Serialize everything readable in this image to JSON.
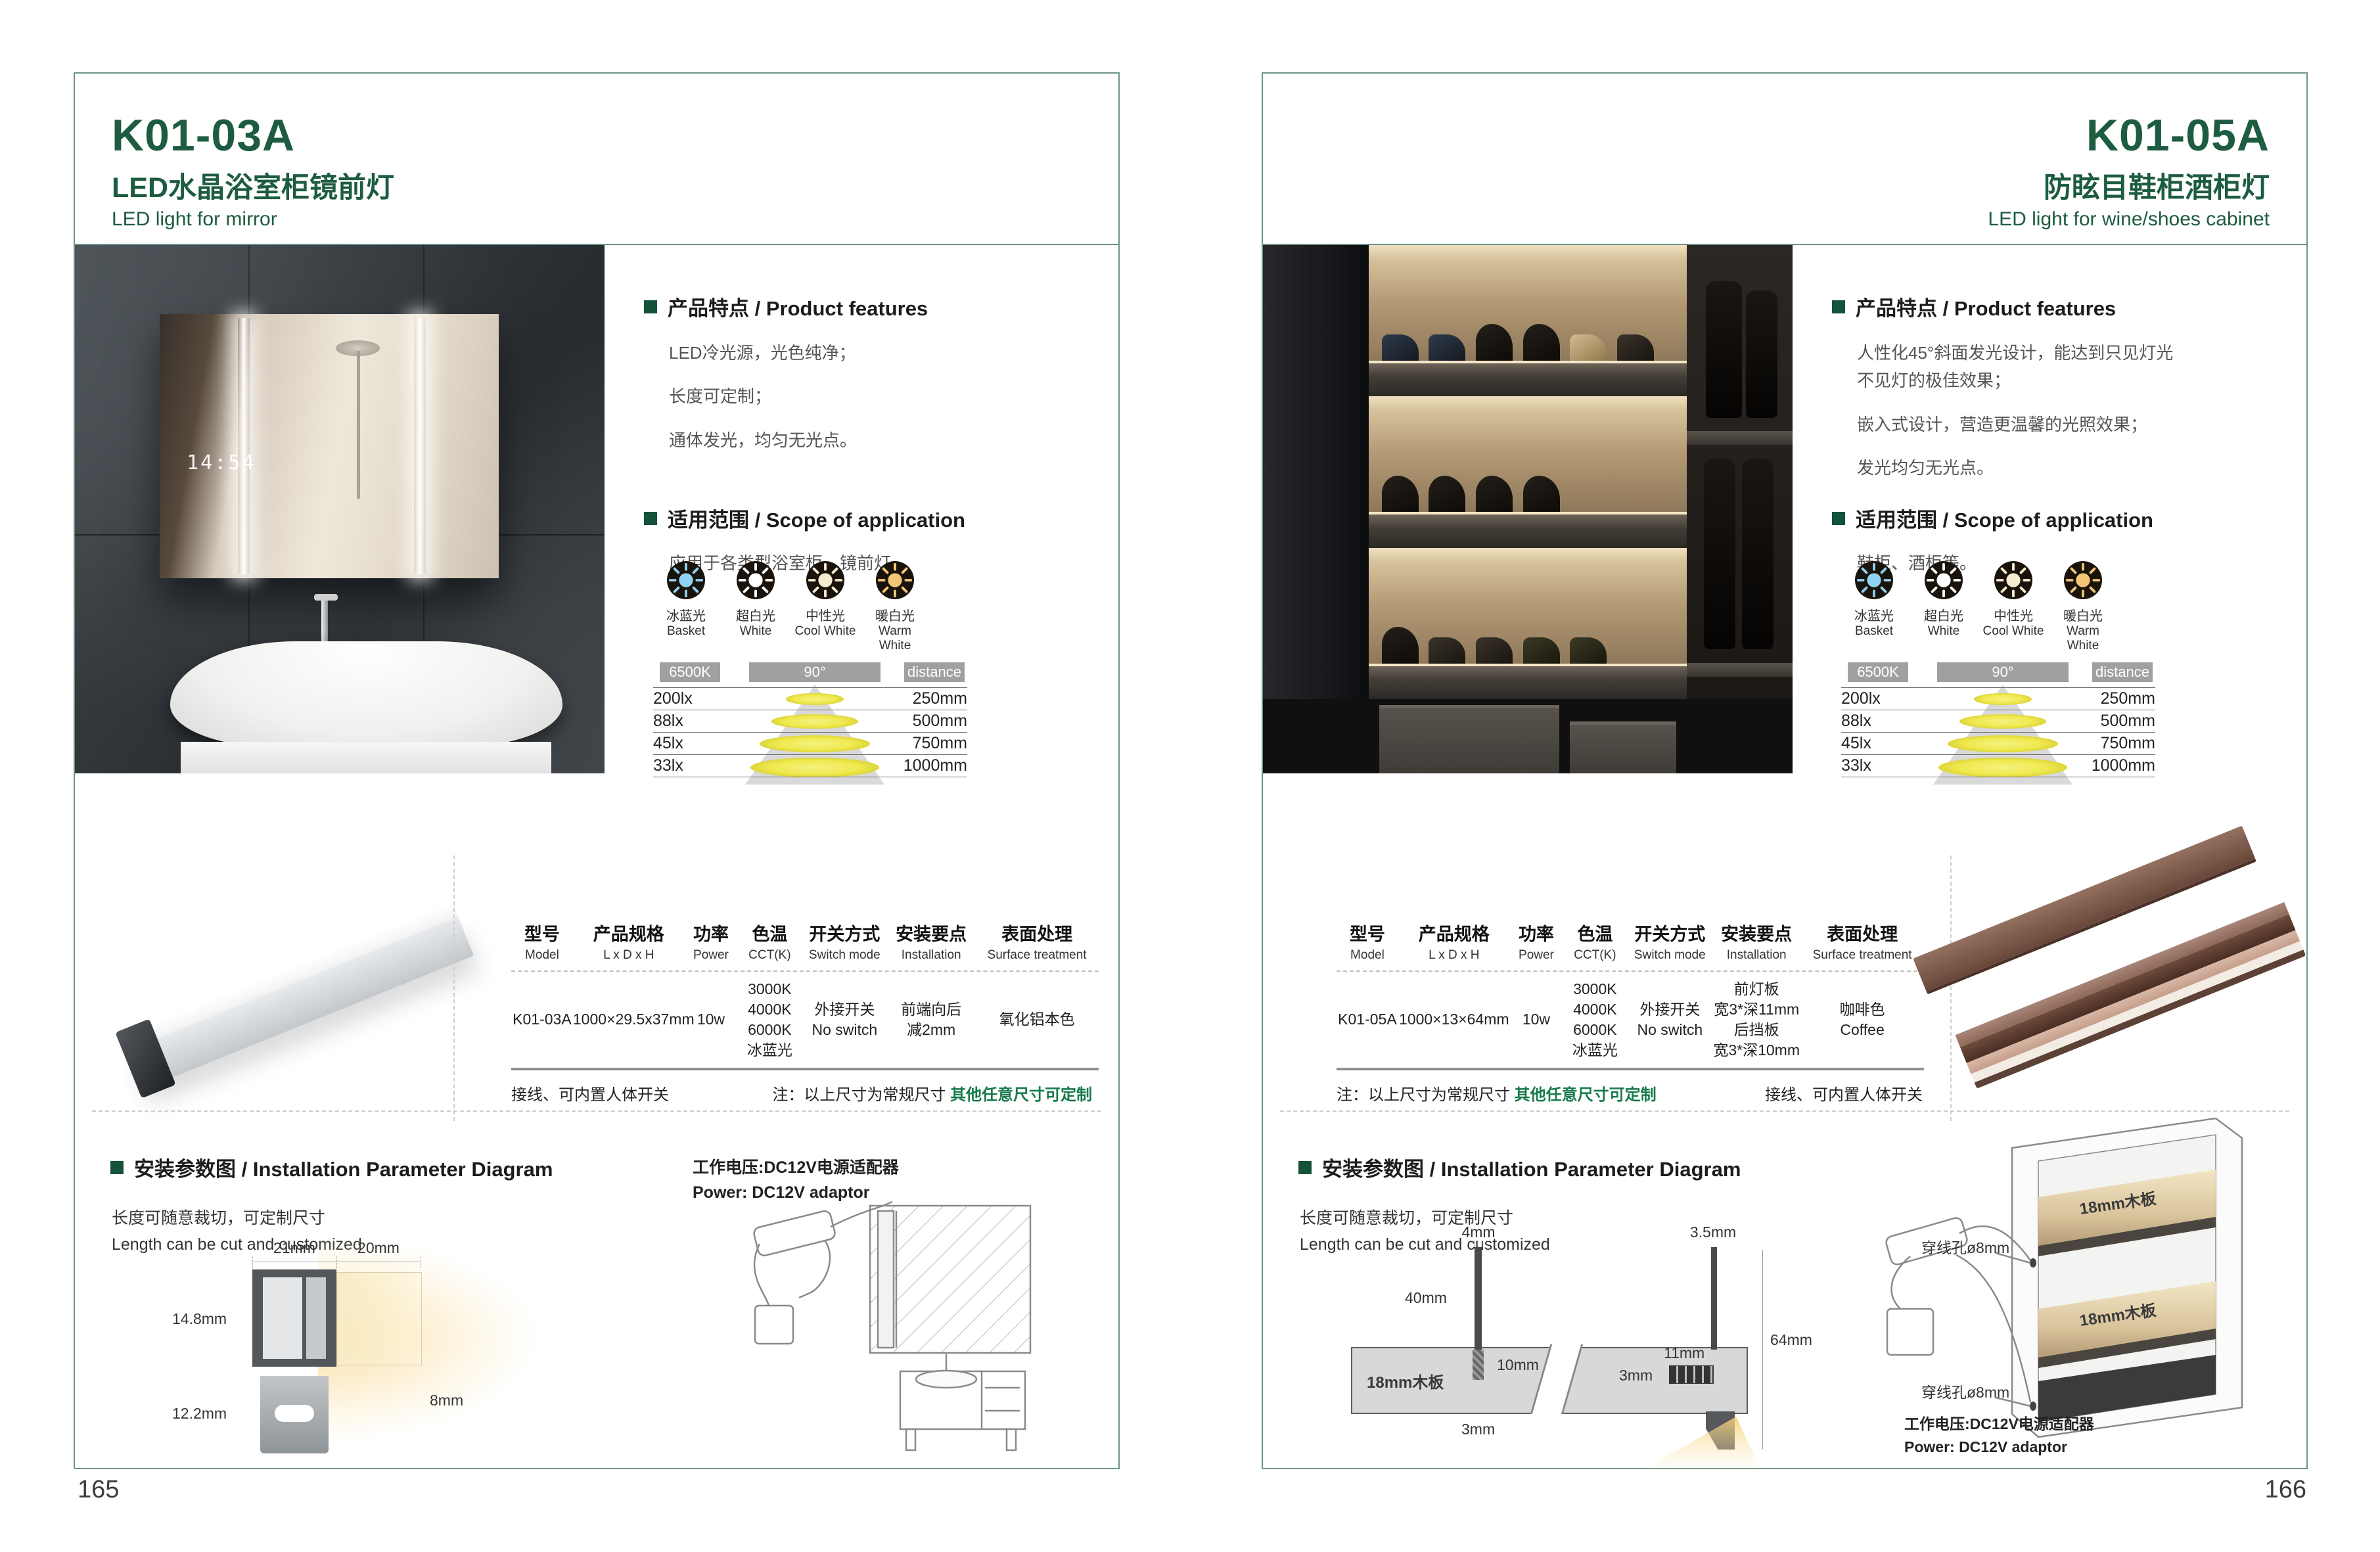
{
  "colors": {
    "brand_green": "#1d5c40",
    "frame_teal": "#6b958a",
    "note_green": "#167a4a",
    "bar_gray": "#a0a0a0"
  },
  "page_numbers": {
    "left": "165",
    "right": "166"
  },
  "shared": {
    "features_header": "产品特点 / Product features",
    "scope_header": "适用范围 / Scope of application",
    "install_header": "安装参数图 / Installation Parameter Diagram",
    "length_note_cn": "长度可随意裁切，可定制尺寸",
    "length_note_en": "Length can be cut and customized",
    "power_note_cn": "工作电压:DC12V电源适配器",
    "power_note_en": "Power: DC12V adaptor",
    "wiring_note": "接线、可内置人体开关",
    "size_note_black": "注：以上尺寸为常规尺寸",
    "size_note_green": "其他任意尺寸可定制",
    "light_options": [
      {
        "cn": "冰蓝光",
        "en": "Basket",
        "color": "#8fd2f2"
      },
      {
        "cn": "超白光",
        "en": "White",
        "color": "#ffffff"
      },
      {
        "cn": "中性光",
        "en": "Cool White",
        "color": "#f6ecd0"
      },
      {
        "cn": "暖白光",
        "en": "Warm White",
        "color": "#f2c674"
      }
    ],
    "beam": {
      "cct": "6500K",
      "angle": "90°",
      "distance": "distance",
      "rows": [
        {
          "lux": "200lx",
          "dist": "250mm"
        },
        {
          "lux": "88lx",
          "dist": "500mm"
        },
        {
          "lux": "45lx",
          "dist": "750mm"
        },
        {
          "lux": "33lx",
          "dist": "1000mm"
        }
      ]
    },
    "table_headers": [
      {
        "cn": "型号",
        "en": "Model"
      },
      {
        "cn": "产品规格",
        "en": "L x D x H"
      },
      {
        "cn": "功率",
        "en": "Power"
      },
      {
        "cn": "色温",
        "en": "CCT(K)"
      },
      {
        "cn": "开关方式",
        "en": "Switch mode"
      },
      {
        "cn": "安装要点",
        "en": "Installation"
      },
      {
        "cn": "表面处理",
        "en": "Surface treatment"
      }
    ]
  },
  "left": {
    "model": "K01-03A",
    "title_cn": "LED水晶浴室柜镜前灯",
    "title_en": "LED light for mirror",
    "features": [
      "LED冷光源，光色纯净；",
      "长度可定制；",
      "通体发光，均匀无光点。"
    ],
    "scope": "应用于各类型浴室柜，镜前灯。",
    "mirror_clock": "14:54",
    "spec": {
      "model": "K01-03A",
      "size": "1000×29.5x37mm",
      "power": "10w",
      "cct": [
        "3000K",
        "4000K",
        "6000K",
        "冰蓝光"
      ],
      "switch": [
        "外接开关",
        "No switch"
      ],
      "install": [
        "前端向后",
        "减2mm"
      ],
      "surface": [
        "氧化铝本色"
      ]
    },
    "dims": {
      "w21": "21mm",
      "w20": "20mm",
      "h148": "14.8mm",
      "h122": "12.2mm",
      "h8": "8mm"
    }
  },
  "right": {
    "model": "K01-05A",
    "title_cn": "防眩目鞋柜酒柜灯",
    "title_en": "LED light for wine/shoes cabinet",
    "features": [
      "人性化45°斜面发光设计，能达到只见灯光",
      "不见灯的极佳效果；",
      "嵌入式设计，营造更温馨的光照效果；",
      "发光均匀无光点。"
    ],
    "scope": "鞋柜、酒柜等。",
    "spec": {
      "model": "K01-05A",
      "size": "1000×13×64mm",
      "power": "10w",
      "cct": [
        "3000K",
        "4000K",
        "6000K",
        "冰蓝光"
      ],
      "switch": [
        "外接开关",
        "No switch"
      ],
      "install": [
        "前灯板",
        "宽3*深11mm",
        "后挡板",
        "宽3*深10mm"
      ],
      "surface": [
        "咖啡色",
        "Coffee"
      ]
    },
    "dims": {
      "d4": "4mm",
      "d40": "40mm",
      "d10": "10mm",
      "d3a": "3mm",
      "board": "18mm木板",
      "d35": "3.5mm",
      "d11": "11mm",
      "d3b": "3mm",
      "d64": "64mm",
      "d3c": "3mm"
    },
    "cab": {
      "hole": "穿线孔ø8mm",
      "board": "18mm木板"
    }
  }
}
